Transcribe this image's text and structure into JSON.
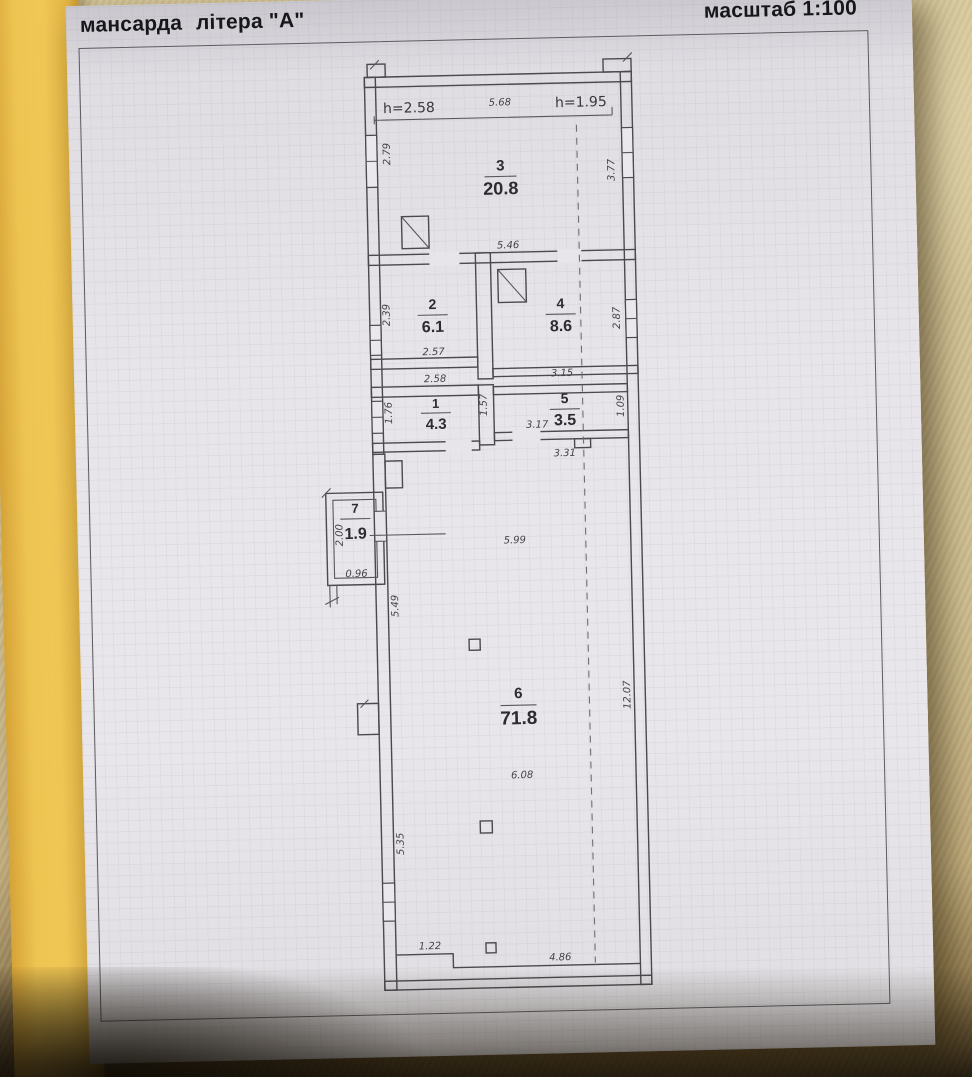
{
  "scene": {
    "colors": {
      "carpet": "#cfbf92",
      "cover": "#eec451",
      "page": "#e7e5e9",
      "ink": "#4a494e"
    }
  },
  "header": {
    "floor_label": "мансарда",
    "letter_label": "літера \"А\"",
    "scale_label": "масштаб 1:100"
  },
  "plan": {
    "heights": {
      "left": "h=2.58",
      "right": "h=1.95"
    },
    "rooms": {
      "r1": {
        "number": "1",
        "area": "4.3"
      },
      "r2": {
        "number": "2",
        "area": "6.1"
      },
      "r3": {
        "number": "3",
        "area": "20.8"
      },
      "r4": {
        "number": "4",
        "area": "8.6"
      },
      "r5": {
        "number": "5",
        "area": "3.5"
      },
      "r6": {
        "number": "6",
        "area": "71.8"
      },
      "r7": {
        "number": "7",
        "area": "1.9"
      }
    },
    "dims": {
      "room3_top": "5.68",
      "room3_left": "2.79",
      "room3_right": "3.77",
      "room3_bottom": "5.46",
      "room2_left": "2.39",
      "room2_bottom": "2.57",
      "room4_right": "2.87",
      "room4_bottom": "3.15",
      "room1_top": "2.58",
      "room1_left": "1.76",
      "rooms1_5_divider": "1.57",
      "room5_bottom_left": "3.17",
      "room5_right": "1.09",
      "room5_below": "3.31",
      "room6_upper_width": "5.99",
      "room6_left_upper": "5.49",
      "room6_mid_width": "6.08",
      "room6_right_height": "12.07",
      "room6_left_lower": "5.35",
      "room6_bottom_left": "1.22",
      "room6_bottom_width": "4.86",
      "room7_left": "2.00",
      "room7_bottom": "0.96"
    }
  }
}
